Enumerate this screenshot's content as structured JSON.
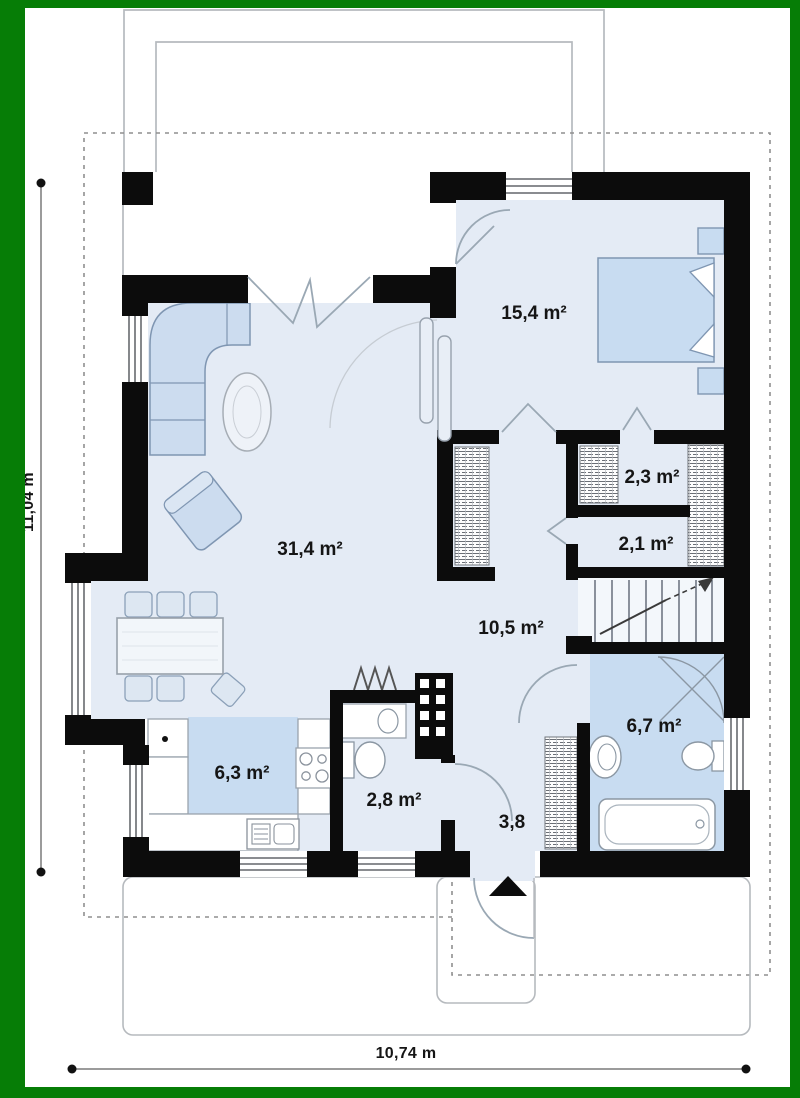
{
  "plan": {
    "rooms": [
      {
        "id": "living-room",
        "area": "31,4 m²"
      },
      {
        "id": "bedroom",
        "area": "15,4 m²"
      },
      {
        "id": "wardrobe-closet",
        "area": "2,3 m²"
      },
      {
        "id": "corridor",
        "area": "2,1 m²"
      },
      {
        "id": "hall-stairs",
        "area": "10,5 m²"
      },
      {
        "id": "bathroom",
        "area": "6,7 m²"
      },
      {
        "id": "kitchen",
        "area": "6,3 m²"
      },
      {
        "id": "wc",
        "area": "2,8 m²"
      },
      {
        "id": "entry",
        "area": "3,8"
      }
    ],
    "dimensions": {
      "overall_width": "10,74 m",
      "overall_height": "11,04 m"
    },
    "colors": {
      "frame_green": "#067d06",
      "wall_black": "#0c0c0c",
      "floor_light": "#e4ebf5",
      "floor_blue": "#c8dcf1",
      "furniture_blue": "#ccdcef"
    }
  }
}
